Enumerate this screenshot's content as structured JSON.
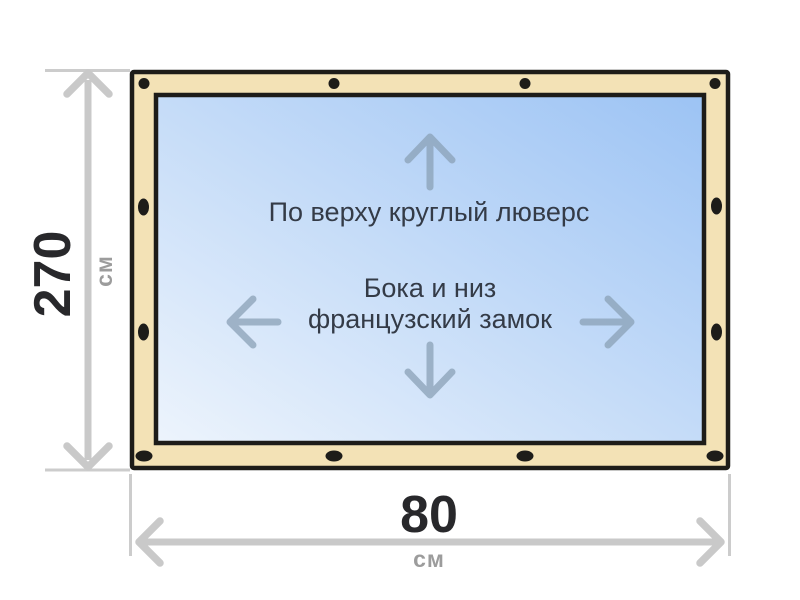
{
  "diagram": {
    "title": "curtain-dimension-diagram",
    "annotations": {
      "top_edge": "По верху круглый люверс",
      "sides_line1": "Бока и низ",
      "sides_line2": "французский замок"
    },
    "height_dim": {
      "value": "270",
      "unit": "см"
    },
    "width_dim": {
      "value": "80",
      "unit": "см"
    },
    "icons": {
      "arrow_up": "↑",
      "arrow_down": "↓",
      "arrow_left": "←",
      "arrow_right": "→",
      "grommet": "•"
    },
    "colors": {
      "background": "#ffffff",
      "frame_fill": "#f3e2b6",
      "frame_border": "#1d1c19",
      "canvas_gradient_start": "#edf4fc",
      "canvas_gradient_end": "#9cc3f4",
      "dimension_gray": "#c9c9c9",
      "direction_arrow": "#8aa0b5",
      "annotation_text": "#343b47",
      "dimension_value_text": "#28282b",
      "dimension_unit_text": "#9c9c9c"
    }
  }
}
